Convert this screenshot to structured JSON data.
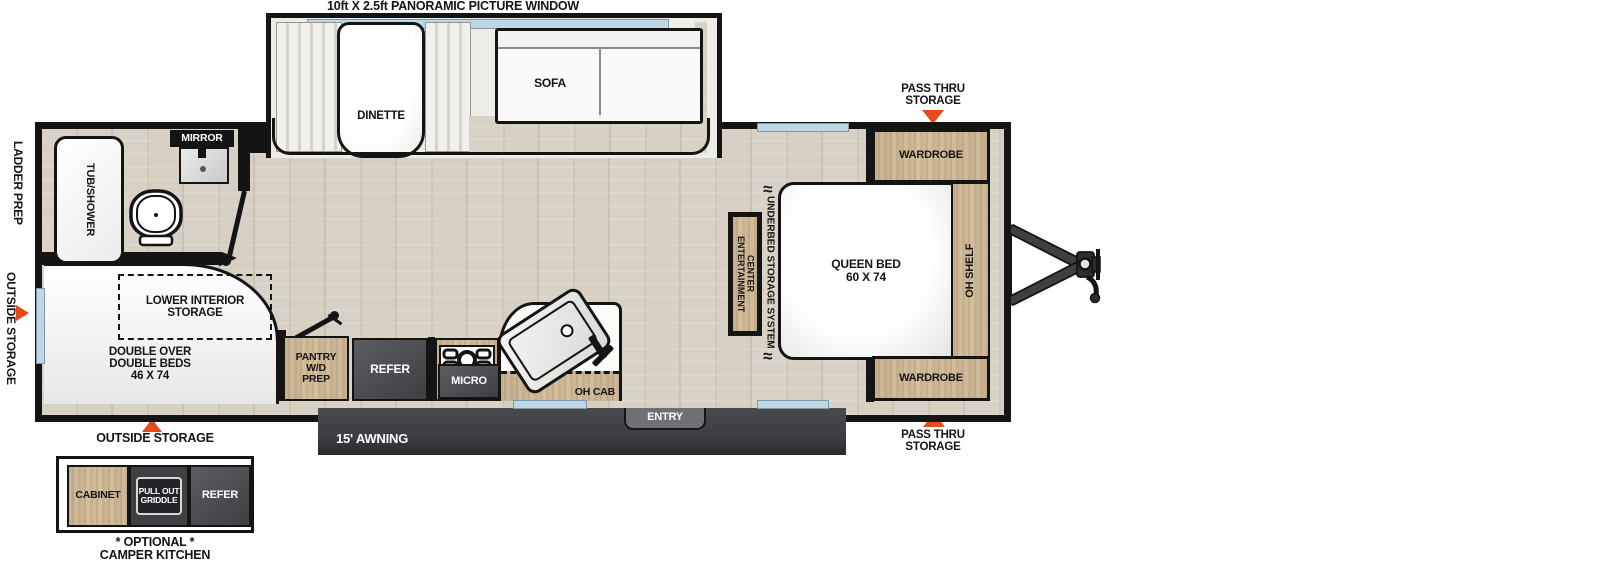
{
  "colors": {
    "accent_red": "#e8481e",
    "window_blue": "#bdd7e7",
    "wall_black": "#141414",
    "cabinet_wood": "#cbb494",
    "appliance_gray": "#4a4b4f"
  },
  "title": "10ft X 2.5ft PANORAMIC PICTURE WINDOW",
  "slide_out": {
    "dinette_label": "DINETTE",
    "sofa_label": "SOFA"
  },
  "exterior": {
    "ladder_prep": "LADDER PREP",
    "outside_storage_side": "OUTSIDE STORAGE",
    "pass_thru_top": "PASS THRU\nSTORAGE",
    "pass_thru_bottom": "PASS THRU\nSTORAGE",
    "outside_storage_bottom": "OUTSIDE STORAGE",
    "awning": "15' AWNING",
    "entry": "ENTRY"
  },
  "bathroom": {
    "tub": "TUB/SHOWER",
    "mirror": "MIRROR"
  },
  "bunk_room": {
    "lower_storage": "LOWER INTERIOR\nSTORAGE",
    "beds": "DOUBLE OVER\nDOUBLE BEDS\n46 X 74"
  },
  "kitchen": {
    "pantry": "PANTRY\nW/D\nPREP",
    "refer": "REFER",
    "micro": "MICRO",
    "oh_cab": "OH CAB"
  },
  "bedroom": {
    "queen_bed": "QUEEN BED\n60 X 74",
    "wardrobe_top": "WARDROBE",
    "wardrobe_bottom": "WARDROBE",
    "oh_shelf": "OH SHELF",
    "underbed": "UNDERBED STORAGE SYSTEM",
    "entertainment": "ENTERTAINMENT\nCENTER"
  },
  "camper_kitchen": {
    "cabinet": "CABINET",
    "griddle": "PULL OUT\nGRIDDLE",
    "refer": "REFER",
    "caption": "* OPTIONAL *\nCAMPER KITCHEN"
  }
}
